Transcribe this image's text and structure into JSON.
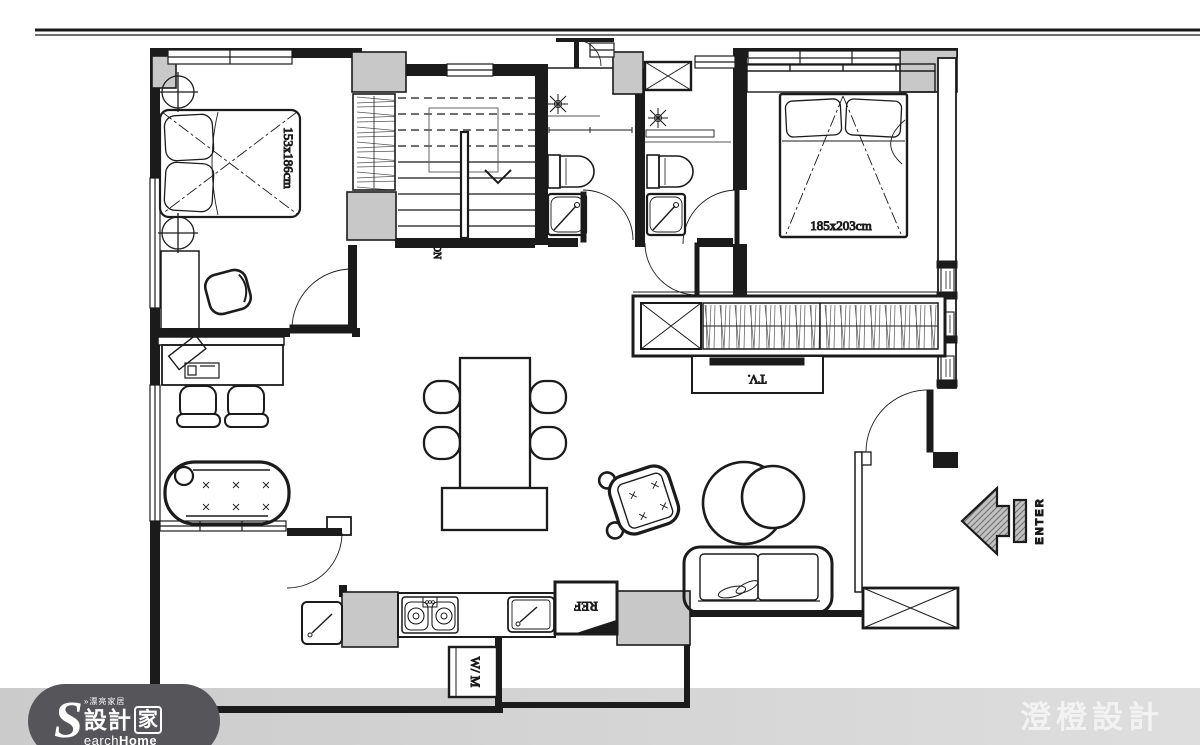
{
  "canvas": {
    "width": 1200,
    "height": 745
  },
  "colors": {
    "wall": "#1b1b1b",
    "pier_gray": "#c8c8c8",
    "bottom_band": "#d4d4d4",
    "logo_background": "#56565a",
    "watermark_text": "#f4f4f4",
    "arrow_hatch": "#6f6f6f"
  },
  "plan": {
    "labels": {
      "bed1_dim": "153x186cm",
      "bed2_dim": "185x203cm",
      "tv": "TV.",
      "fridge": "REF",
      "washer": "W/ M",
      "stairs_dn": "DN",
      "entry": "ENTER"
    }
  },
  "brand": {
    "logo_initial": "S",
    "logo_tagline": "»漂亮家居",
    "logo_cn_left": "設計",
    "logo_cn_right": "家",
    "logo_en_rest": "earch",
    "logo_en_bold": "Home",
    "watermark": "澄橙設計"
  }
}
